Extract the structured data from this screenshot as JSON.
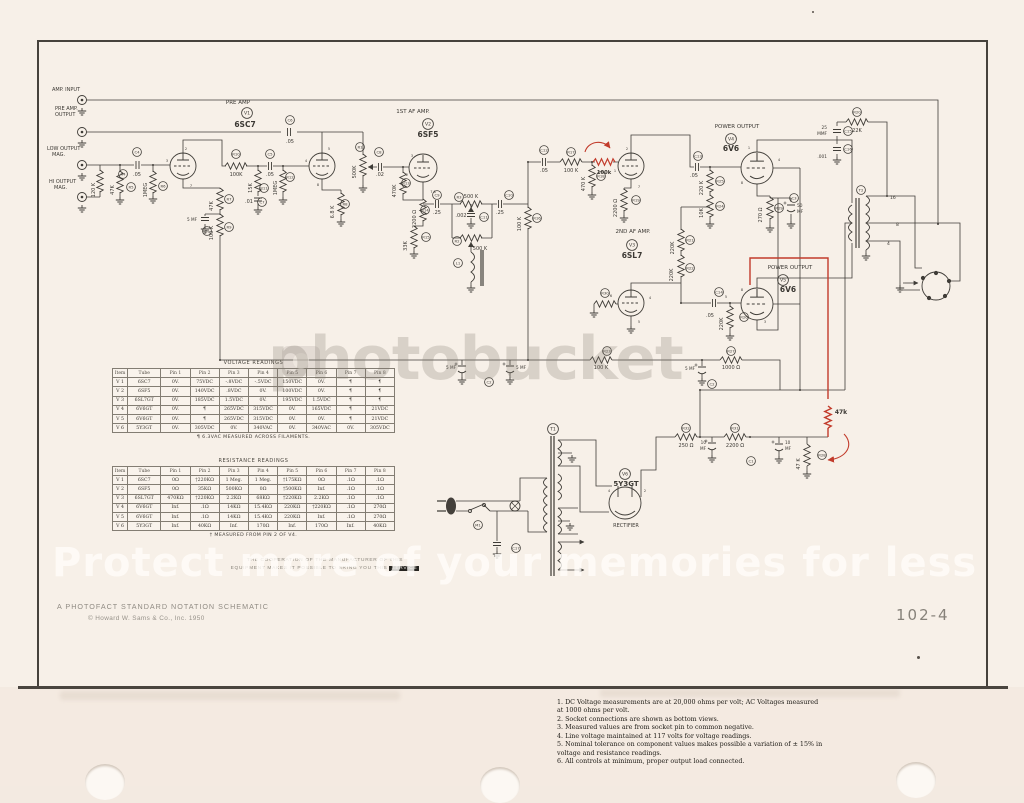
{
  "page": {
    "catalog_number": "102-4",
    "footer_line1": "A PHOTOFACT STANDARD NOTATION SCHEMATIC",
    "footer_line2": "© Howard W. Sams & Co., Inc. 1950",
    "coop_line1": "THE COOPERATION OF THE MANUFACTURER OF THIS",
    "coop_line2": "EQUIPMENT MAKES IT POSSIBLE TO BRING YOU THIS ",
    "coop_line2_highlight": "SERVICE"
  },
  "watermark": {
    "brand": "photobucket",
    "tagline": "Protect more of your memories for less"
  },
  "notes": {
    "items": [
      "1. DC Voltage measurements are at 20,000 ohms per volt; AC Voltages measured at 1000 ohms per volt.",
      "2.  Socket connections are shown as bottom views.",
      "3.  Measured values are from socket pin to common negative.",
      "4.  Line voltage maintained at 117 volts for voltage readings.",
      "5.  Nominal tolerance on component values makes possible a variation of ± 15% in voltage and resistance readings.",
      "6. All controls at minimum, proper output load connected."
    ]
  },
  "voltage_table": {
    "title": "VOLTAGE READINGS",
    "headers": [
      "Item",
      "Tube",
      "Pin 1",
      "Pin 2",
      "Pin 3",
      "Pin 4",
      "Pin 5",
      "Pin 6",
      "Pin 7",
      "Pin 8"
    ],
    "rows": [
      [
        "V 1",
        "6SC7",
        "0V.",
        "75VDC",
        "-.8VDC",
        "-.5VDC",
        "150VDC",
        "0V.",
        "¶",
        "¶"
      ],
      [
        "V 2",
        "6SF5",
        "0V.",
        "140VDC",
        ".8VDC",
        "0V.",
        "100VDC",
        "0V.",
        "¶",
        "¶"
      ],
      [
        "V 3",
        "6SL7GT",
        "0V.",
        "185VDC",
        "1.5VDC",
        "0V.",
        "195VDC",
        "1.5VDC",
        "¶",
        "¶"
      ],
      [
        "V 4",
        "6V6GT",
        "0V.",
        "¶",
        "265VDC",
        "315VDC",
        "0V.",
        "165VDC",
        "¶",
        "21VDC"
      ],
      [
        "V 5",
        "6V6GT",
        "0V.",
        "¶",
        "265VDC",
        "315VDC",
        "0V.",
        "0V.",
        "¶",
        "21VDC"
      ],
      [
        "V 6",
        "5Y3GT",
        "0V.",
        "305VDC",
        "0V.",
        "340VAC",
        "0V.",
        "340VAC",
        "0V.",
        "305VDC"
      ]
    ],
    "footnote": "¶ 6.3VAC MEASURED ACROSS FILAMENTS."
  },
  "resistance_table": {
    "title": "RESISTANCE READINGS",
    "headers": [
      "Item",
      "Tube",
      "Pin 1",
      "Pin 2",
      "Pin 3",
      "Pin 4",
      "Pin 5",
      "Pin 6",
      "Pin 7",
      "Pin 8"
    ],
    "rows": [
      [
        "V 1",
        "6SC7",
        "0Ω",
        "†220KΩ",
        "1 Meg.",
        "1 Meg.",
        "†175KΩ",
        "0Ω",
        ".1Ω",
        ".1Ω"
      ],
      [
        "V 2",
        "6SF5",
        "0Ω",
        "35KΩ",
        "500KΩ",
        "0Ω",
        "†500KΩ",
        "Inf.",
        ".1Ω",
        ".1Ω"
      ],
      [
        "V 3",
        "6SL7GT",
        "470KΩ",
        "†220KΩ",
        "2.2KΩ",
        "68KΩ",
        "†220KΩ",
        "2.2KΩ",
        ".1Ω",
        ".1Ω"
      ],
      [
        "V 4",
        "6V6GT",
        "Inf.",
        ".1Ω",
        "14KΩ",
        "15.4KΩ",
        "220KΩ",
        "†220KΩ",
        ".1Ω",
        "270Ω"
      ],
      [
        "V 5",
        "6V6GT",
        "Inf.",
        ".1Ω",
        "14KΩ",
        "15.4KΩ",
        "220KΩ",
        "Inf.",
        ".1Ω",
        "270Ω"
      ],
      [
        "V 6",
        "5Y3GT",
        "Inf.",
        "40KΩ",
        "Inf.",
        "170Ω",
        "Inf.",
        "170Ω",
        "Inf.",
        "40KΩ"
      ]
    ],
    "footnote": "† MEASURED FROM PIN 2 OF V4."
  },
  "schematic": {
    "labels": [
      {
        "t": "PRE AMP",
        "x": 238,
        "y": 104,
        "s": 5.5
      },
      {
        "t": "6SC7",
        "x": 245,
        "y": 127,
        "s": 7.5,
        "w": 1
      },
      {
        "t": "1ST AF AMP.",
        "x": 413,
        "y": 113,
        "s": 5.5
      },
      {
        "t": "6SF5",
        "x": 428,
        "y": 137,
        "s": 7.5,
        "w": 1
      },
      {
        "t": "2ND AF AMP.",
        "x": 633,
        "y": 233,
        "s": 5.5
      },
      {
        "t": "6SL7",
        "x": 632,
        "y": 258,
        "s": 7.5,
        "w": 1
      },
      {
        "t": "POWER OUTPUT",
        "x": 737,
        "y": 128,
        "s": 5.5
      },
      {
        "t": "6V6",
        "x": 731,
        "y": 151,
        "s": 7.5,
        "w": 1
      },
      {
        "t": "POWER OUTPUT",
        "x": 790,
        "y": 269,
        "s": 5.5
      },
      {
        "t": "6V6",
        "x": 788,
        "y": 292,
        "s": 7.5,
        "w": 1
      },
      {
        "t": "5Y3GT",
        "x": 626,
        "y": 486,
        "s": 7,
        "w": 1
      },
      {
        "t": "RECTIFIER",
        "x": 626,
        "y": 527,
        "s": 5,
        "c": "#8d887f"
      },
      {
        "t": "AMP. INPUT",
        "x": 52,
        "y": 91,
        "a": "s"
      },
      {
        "t": "PRE AMP.",
        "x": 55,
        "y": 110,
        "a": "s"
      },
      {
        "t": "OUTPUT",
        "x": 55,
        "y": 116,
        "a": "s"
      },
      {
        "t": "LOW OUTPUT",
        "x": 47,
        "y": 150,
        "a": "s"
      },
      {
        "t": "MAG.",
        "x": 52,
        "y": 156,
        "a": "s"
      },
      {
        "t": "HI OUTPUT",
        "x": 49,
        "y": 183,
        "a": "s"
      },
      {
        "t": "MAG.",
        "x": 54,
        "y": 189,
        "a": "s"
      },
      {
        "t": "120 K",
        "x": 95,
        "y": 190,
        "r": 1
      },
      {
        "t": "47K",
        "x": 114,
        "y": 190,
        "r": 1
      },
      {
        "t": ".05",
        "x": 137,
        "y": 176
      },
      {
        "t": "1MEG",
        "x": 147,
        "y": 190,
        "r": 1
      },
      {
        "t": "100K",
        "x": 236,
        "y": 176
      },
      {
        "t": "15K",
        "x": 252,
        "y": 188,
        "r": 1
      },
      {
        "t": ".01",
        "x": 249,
        "y": 203
      },
      {
        "t": ".05",
        "x": 270,
        "y": 176
      },
      {
        "t": "1MEG",
        "x": 277,
        "y": 188,
        "r": 1
      },
      {
        "t": ".05",
        "x": 290,
        "y": 143
      },
      {
        "t": "500K",
        "x": 356,
        "y": 172,
        "r": 1
      },
      {
        "t": "47K",
        "x": 213,
        "y": 206,
        "r": 1
      },
      {
        "t": "5 MF",
        "x": 197,
        "y": 221,
        "s": 4.2,
        "a": "e"
      },
      {
        "t": "100 K",
        "x": 213,
        "y": 233,
        "r": 1
      },
      {
        "t": "6.8 K",
        "x": 334,
        "y": 212,
        "r": 1
      },
      {
        "t": ".02",
        "x": 380,
        "y": 176
      },
      {
        "t": "470K",
        "x": 396,
        "y": 191,
        "r": 1
      },
      {
        "t": "2200 Ω",
        "x": 416,
        "y": 219,
        "r": 1
      },
      {
        "t": "33K",
        "x": 407,
        "y": 246,
        "r": 1
      },
      {
        "t": ".25",
        "x": 437,
        "y": 214
      },
      {
        "t": "500 K",
        "x": 471,
        "y": 198
      },
      {
        "t": ".002",
        "x": 461,
        "y": 217
      },
      {
        "t": "500 K",
        "x": 480,
        "y": 250
      },
      {
        "t": ".25",
        "x": 500,
        "y": 214
      },
      {
        "t": "100 K",
        "x": 521,
        "y": 224,
        "r": 1
      },
      {
        "t": ".05",
        "x": 544,
        "y": 172
      },
      {
        "t": "100 K",
        "x": 571,
        "y": 172
      },
      {
        "t": "470 K",
        "x": 585,
        "y": 184,
        "r": 1
      },
      {
        "t": "2200 Ω",
        "x": 617,
        "y": 208,
        "r": 1
      },
      {
        "t": "220K",
        "x": 674,
        "y": 248,
        "r": 1
      },
      {
        "t": "220 K",
        "x": 703,
        "y": 188,
        "r": 1
      },
      {
        "t": "10K",
        "x": 703,
        "y": 213,
        "r": 1
      },
      {
        "t": ".05",
        "x": 694,
        "y": 177
      },
      {
        "t": "25",
        "x": 827,
        "y": 129,
        "s": 4.3,
        "a": "e"
      },
      {
        "t": "MMF",
        "x": 827,
        "y": 135,
        "s": 4.3,
        "a": "e"
      },
      {
        "t": ".001",
        "x": 827,
        "y": 158,
        "s": 4.3,
        "a": "e"
      },
      {
        "t": "22K",
        "x": 857,
        "y": 132
      },
      {
        "t": "270 Ω",
        "x": 762,
        "y": 215,
        "r": 1
      },
      {
        "t": "50",
        "x": 797,
        "y": 207,
        "s": 4.3,
        "a": "s"
      },
      {
        "t": "MF",
        "x": 797,
        "y": 213,
        "s": 4.3,
        "a": "s"
      },
      {
        "t": "220K",
        "x": 673,
        "y": 275,
        "r": 1
      },
      {
        "t": ".05",
        "x": 710,
        "y": 317
      },
      {
        "t": "220K",
        "x": 723,
        "y": 324,
        "r": 1
      },
      {
        "t": "100 K",
        "x": 601,
        "y": 369
      },
      {
        "t": "5 MF",
        "x": 695,
        "y": 370,
        "s": 4.2,
        "a": "e"
      },
      {
        "t": "1000 Ω",
        "x": 731,
        "y": 369
      },
      {
        "t": "5 MF",
        "x": 456,
        "y": 369,
        "s": 4.2,
        "a": "e"
      },
      {
        "t": "5 MF",
        "x": 516,
        "y": 369,
        "s": 4.2,
        "a": "s"
      },
      {
        "t": "250 Ω",
        "x": 686,
        "y": 447
      },
      {
        "t": "10",
        "x": 706,
        "y": 444,
        "s": 4.2,
        "a": "e"
      },
      {
        "t": "MF",
        "x": 706,
        "y": 450,
        "s": 4.2,
        "a": "e"
      },
      {
        "t": "10",
        "x": 785,
        "y": 444,
        "s": 4.2,
        "a": "s"
      },
      {
        "t": "MF",
        "x": 785,
        "y": 450,
        "s": 4.2,
        "a": "s"
      },
      {
        "t": "2200 Ω",
        "x": 735,
        "y": 447
      },
      {
        "t": "47 K",
        "x": 800,
        "y": 464,
        "r": 1
      },
      {
        "t": "16",
        "x": 890,
        "y": 199,
        "s": 4.5,
        "a": "s"
      },
      {
        "t": "8",
        "x": 896,
        "y": 226,
        "s": 4.5,
        "a": "s"
      },
      {
        "t": "4",
        "x": 887,
        "y": 245,
        "s": 4.5,
        "a": "s"
      },
      {
        "t": "100k",
        "x": 604,
        "y": 174,
        "s": 5.2,
        "c": "#c23b2b",
        "w": 1
      },
      {
        "t": "47k",
        "x": 841,
        "y": 414,
        "s": 6,
        "c": "#c23b2b",
        "w": 1
      },
      {
        "t": "3",
        "x": 167,
        "y": 162,
        "s": 3.5
      },
      {
        "t": "2",
        "x": 186,
        "y": 150,
        "s": 3.5
      },
      {
        "t": "7",
        "x": 191,
        "y": 187,
        "s": 3.5
      },
      {
        "t": "4",
        "x": 306,
        "y": 162,
        "s": 3.5
      },
      {
        "t": "5",
        "x": 329,
        "y": 150,
        "s": 3.5
      },
      {
        "t": "8",
        "x": 318,
        "y": 186,
        "s": 3.5
      },
      {
        "t": "3",
        "x": 412,
        "y": 157,
        "s": 3.5
      },
      {
        "t": "2",
        "x": 407,
        "y": 176,
        "s": 3.5
      },
      {
        "t": "7  8",
        "x": 433,
        "y": 193,
        "s": 3.5
      },
      {
        "t": "2",
        "x": 627,
        "y": 150,
        "s": 3.5
      },
      {
        "t": "1",
        "x": 615,
        "y": 172,
        "s": 3.5
      },
      {
        "t": "7",
        "x": 639,
        "y": 188,
        "s": 3.5
      },
      {
        "t": "1",
        "x": 749,
        "y": 149,
        "s": 3.5
      },
      {
        "t": "4",
        "x": 779,
        "y": 161,
        "s": 3.5
      },
      {
        "t": "8",
        "x": 742,
        "y": 184,
        "s": 3.5
      },
      {
        "t": "6",
        "x": 611,
        "y": 297,
        "s": 3.5
      },
      {
        "t": "4",
        "x": 650,
        "y": 299,
        "s": 3.5
      },
      {
        "t": "5",
        "x": 639,
        "y": 323,
        "s": 3.5
      },
      {
        "t": "5",
        "x": 726,
        "y": 298,
        "s": 3.5
      },
      {
        "t": "3",
        "x": 765,
        "y": 323,
        "s": 3.5
      },
      {
        "t": "8",
        "x": 742,
        "y": 291,
        "s": 3.5
      },
      {
        "t": "4",
        "x": 609,
        "y": 492,
        "s": 3.5
      },
      {
        "t": "2",
        "x": 645,
        "y": 492,
        "s": 3.5
      }
    ],
    "refs": [
      {
        "t": "V1",
        "x": 247,
        "y": 113,
        "b": 1
      },
      {
        "t": "V2",
        "x": 428,
        "y": 124,
        "b": 1
      },
      {
        "t": "V3",
        "x": 632,
        "y": 245,
        "b": 1
      },
      {
        "t": "V4",
        "x": 731,
        "y": 139,
        "b": 1
      },
      {
        "t": "V5",
        "x": 783,
        "y": 280,
        "b": 1
      },
      {
        "t": "V6",
        "x": 625,
        "y": 474,
        "b": 1
      },
      {
        "t": "R4",
        "x": 123,
        "y": 174
      },
      {
        "t": "R5",
        "x": 131,
        "y": 187
      },
      {
        "t": "C4",
        "x": 137,
        "y": 152
      },
      {
        "t": "R6",
        "x": 163,
        "y": 186
      },
      {
        "t": "R10",
        "x": 236,
        "y": 154
      },
      {
        "t": "C5",
        "x": 270,
        "y": 154
      },
      {
        "t": "R11",
        "x": 264,
        "y": 188
      },
      {
        "t": "C7",
        "x": 262,
        "y": 202
      },
      {
        "t": "R12",
        "x": 290,
        "y": 177
      },
      {
        "t": "C6",
        "x": 290,
        "y": 120
      },
      {
        "t": "R1",
        "x": 360,
        "y": 147
      },
      {
        "t": "R7",
        "x": 229,
        "y": 199
      },
      {
        "t": "C1",
        "x": 207,
        "y": 231
      },
      {
        "t": "R9",
        "x": 229,
        "y": 227
      },
      {
        "t": "R8",
        "x": 345,
        "y": 204
      },
      {
        "t": "C8",
        "x": 379,
        "y": 152
      },
      {
        "t": "R13",
        "x": 406,
        "y": 183
      },
      {
        "t": "R14",
        "x": 425,
        "y": 210
      },
      {
        "t": "R15",
        "x": 426,
        "y": 237
      },
      {
        "t": "C9",
        "x": 437,
        "y": 195
      },
      {
        "t": "R3",
        "x": 459,
        "y": 197
      },
      {
        "t": "C11",
        "x": 484,
        "y": 217
      },
      {
        "t": "R2",
        "x": 457,
        "y": 241
      },
      {
        "t": "L1",
        "x": 458,
        "y": 263
      },
      {
        "t": "C10",
        "x": 509,
        "y": 195
      },
      {
        "t": "R16",
        "x": 537,
        "y": 218
      },
      {
        "t": "C12",
        "x": 544,
        "y": 150
      },
      {
        "t": "R17",
        "x": 571,
        "y": 152
      },
      {
        "t": "R18",
        "x": 601,
        "y": 176
      },
      {
        "t": "R19",
        "x": 636,
        "y": 200
      },
      {
        "t": "R21",
        "x": 690,
        "y": 240
      },
      {
        "t": "R25",
        "x": 720,
        "y": 181
      },
      {
        "t": "R24",
        "x": 720,
        "y": 206
      },
      {
        "t": "C13",
        "x": 698,
        "y": 156
      },
      {
        "t": "C15",
        "x": 848,
        "y": 131
      },
      {
        "t": "C16",
        "x": 848,
        "y": 149
      },
      {
        "t": "R20",
        "x": 857,
        "y": 112
      },
      {
        "t": "T2",
        "x": 861,
        "y": 190
      },
      {
        "t": "R29",
        "x": 779,
        "y": 208
      },
      {
        "t": "C3",
        "x": 794,
        "y": 198
      },
      {
        "t": "R22",
        "x": 690,
        "y": 268
      },
      {
        "t": "C14",
        "x": 719,
        "y": 292
      },
      {
        "t": "R26",
        "x": 744,
        "y": 317
      },
      {
        "t": "R23",
        "x": 607,
        "y": 351
      },
      {
        "t": "C2",
        "x": 489,
        "y": 382
      },
      {
        "t": "C2",
        "x": 712,
        "y": 384
      },
      {
        "t": "R27",
        "x": 731,
        "y": 351
      },
      {
        "t": "T1",
        "x": 553,
        "y": 429,
        "b": 1
      },
      {
        "t": "M1",
        "x": 478,
        "y": 525
      },
      {
        "t": "C17",
        "x": 516,
        "y": 548
      },
      {
        "t": "R32",
        "x": 686,
        "y": 428
      },
      {
        "t": "R31",
        "x": 735,
        "y": 428
      },
      {
        "t": "C1",
        "x": 751,
        "y": 461
      },
      {
        "t": "R28",
        "x": 822,
        "y": 455
      },
      {
        "t": "R30",
        "x": 605,
        "y": 293
      }
    ]
  }
}
